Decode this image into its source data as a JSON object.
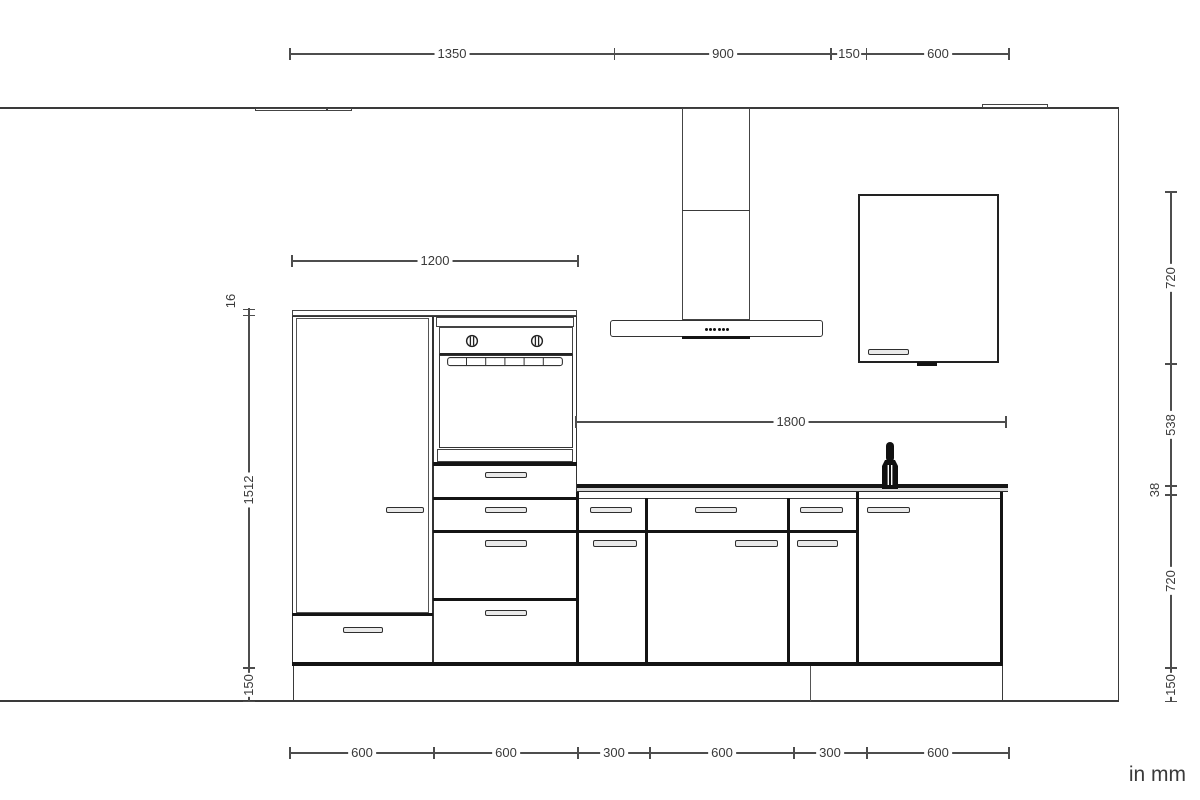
{
  "drawing": {
    "type_label": "kitchen elevation drawing",
    "units_note": "in mm"
  },
  "dims": {
    "top": [
      "1350",
      "900",
      "150",
      "600"
    ],
    "bottom": [
      "600",
      "600",
      "300",
      "600",
      "300",
      "600"
    ],
    "left": [
      "16",
      "1512",
      "150"
    ],
    "right": [
      "720",
      "538",
      "38",
      "720",
      "150"
    ],
    "tall_run_width": "1200",
    "worktop_run_width": "1800"
  },
  "colors": {
    "line": "#3a3a3a",
    "dim_line": "#4d4d4d",
    "bold_front_divider": "#141414",
    "countertop": "#161616",
    "background": "#ffffff"
  },
  "icons": {
    "faucet": "faucet-icon",
    "oven_knob": "oven-knob-icon",
    "hood_controls": "hood-control-dots"
  }
}
